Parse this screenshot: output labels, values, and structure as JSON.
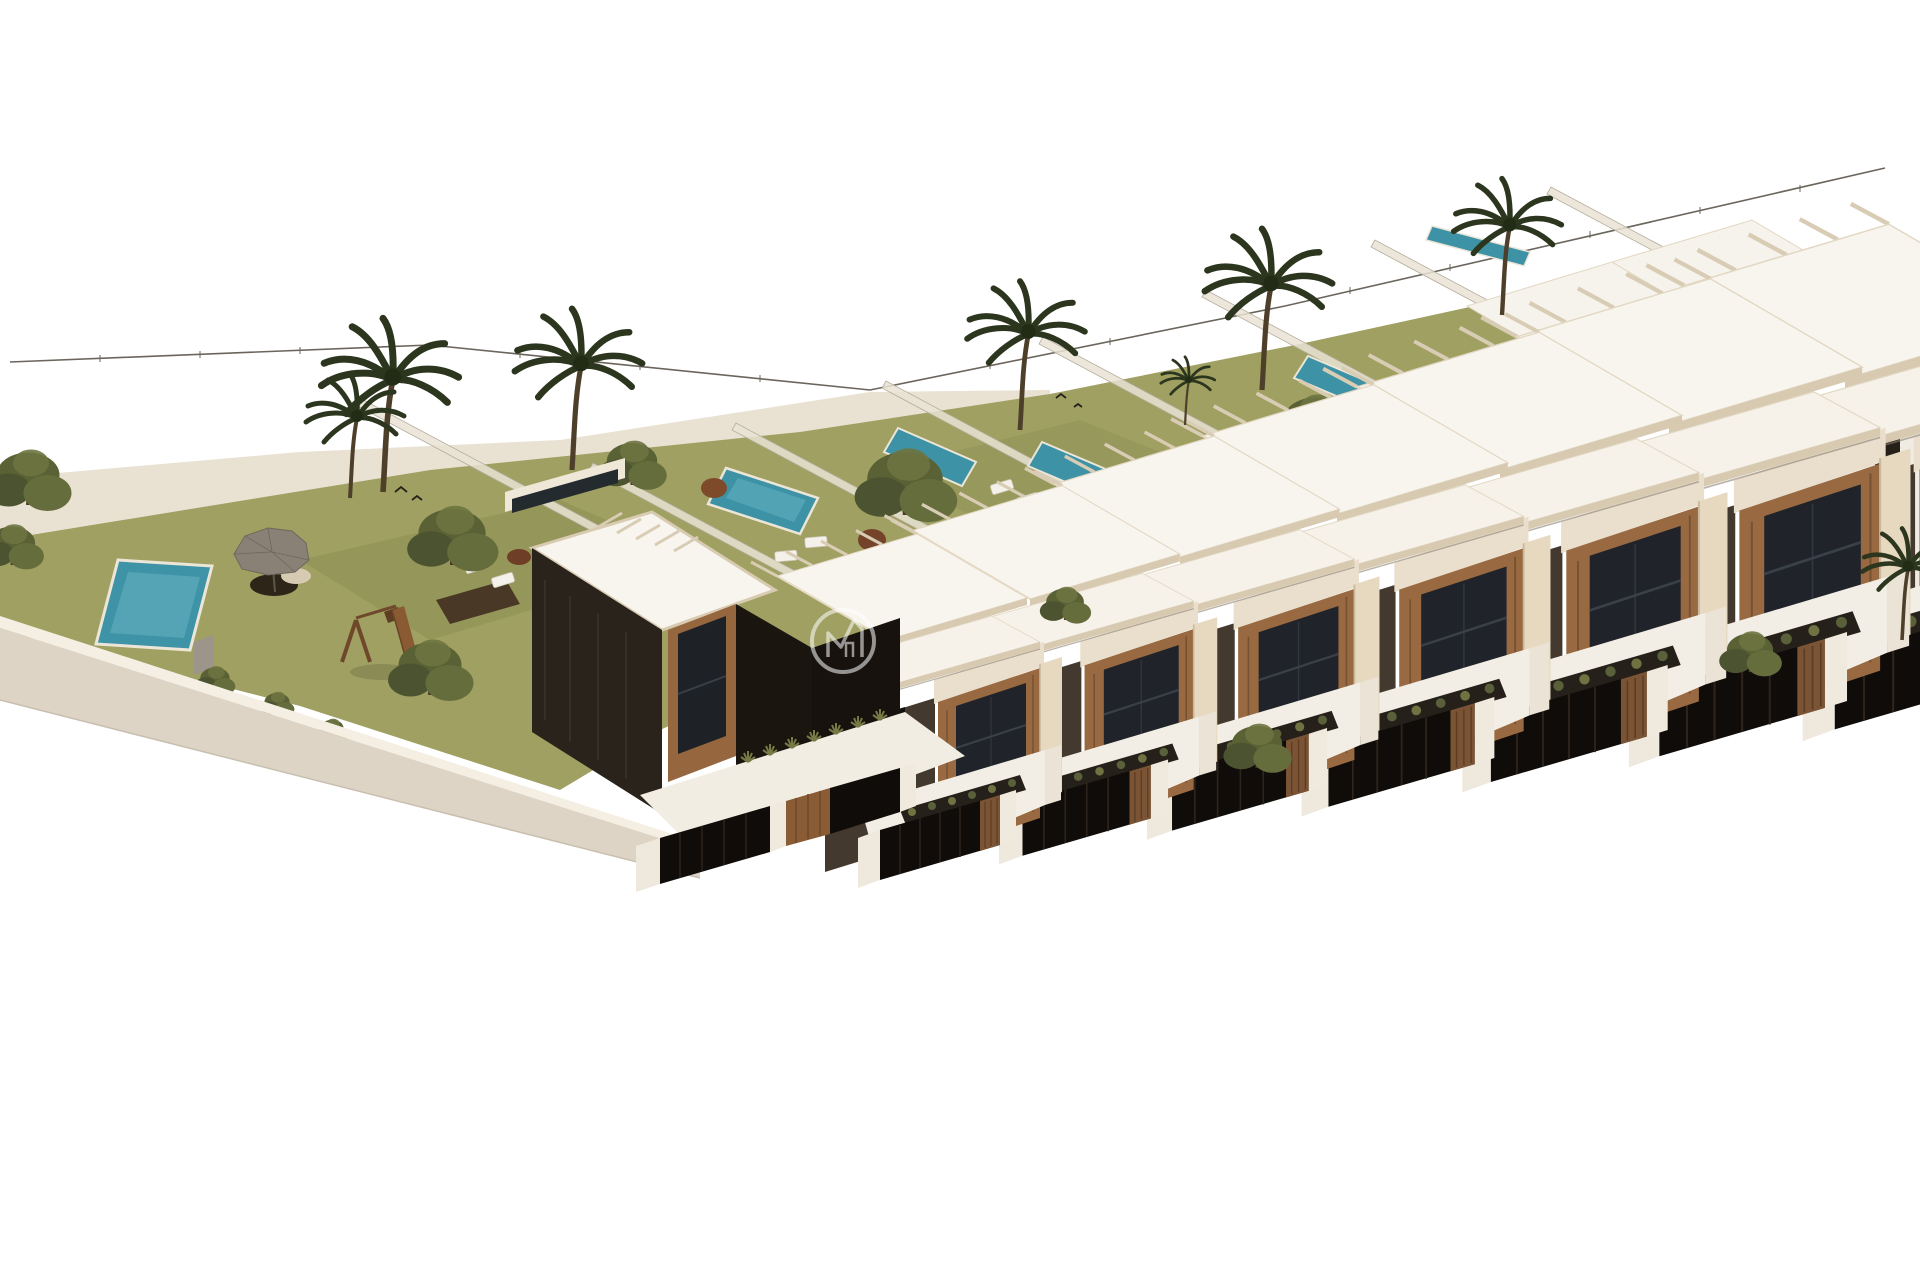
{
  "meta": {
    "title": "Aerial 3D render of new-build townhouse development",
    "description": "Isometric aerial architectural visualization of a diagonal row of modern two-storey townhouses with flat white roofs, beige parapets, wood-clad window bays and dark feature walls. Each unit has a front patio with a sunken planter and dark slatted street fence, plus a private rear garden with lawn, narrow lap pool and translucent glass dividers. A dark detached corner villa anchors the row. To the left is a communal area with lawn, swimming pool, grey parasol lounge set, timber playground, trees and palms, enclosed by a curved white perimeter wall. A thin wire boundary fence runs along the rear. A semi-transparent circular monogram watermark sits near the centre.",
    "view": "aerial-isometric",
    "background_color": "#ffffff"
  },
  "watermark": {
    "shape": "circle-outline",
    "monogram": "M-with-gable house mark",
    "color": "#ffffff",
    "opacity": 0.55
  },
  "palette": {
    "background": "#ffffff",
    "lawn": "#9fa061",
    "lawn_shade": "#8a8c52",
    "sand_path": "#e9e1d2",
    "pool_water": "#3e92a5",
    "pool_water_light": "#66b3c2",
    "roof_white": "#f8f5ef",
    "parapet_beige": "#d8cab1",
    "pillar_beige": "#e7d9c0",
    "white_wall": "#efe9dd",
    "wall_shadow": "#ded4c6",
    "dark_facade": "#43392f",
    "charcoal": "#15100c",
    "wood_cladding": "#996a41",
    "window_glass": "#20242a",
    "glass_fence": "#e9e3d4",
    "tree_foliage": "#5a6134",
    "palm_foliage": "#2c351d",
    "trunk": "#4e3f2a",
    "planter_dark": "#26201a",
    "street_fence": "#0f0c09",
    "parasol_grey": "#8a8176",
    "playground_wood": "#7a4e2a",
    "boundary_wire": "#6b655c"
  },
  "site": {
    "communal_area": {
      "features": [
        "lawn",
        "swimming-pool",
        "parasol-lounge-set",
        "timber-playground",
        "sun-loungers",
        "timber-deck",
        "entrance-gate",
        "perimeter-wall",
        "ornamental-trees",
        "palm-trees",
        "sand-path"
      ]
    },
    "townhouse_row": {
      "visible_units": 7,
      "detached_end_villa": 1,
      "unit_features": [
        "flat-white-roof",
        "beige-parapet",
        "rear-pergola",
        "wood-clad-window-bay",
        "two-storey-glazing",
        "dark-feature-wall",
        "front-patio",
        "sunken-planter",
        "dark-slat-fence",
        "white-pier",
        "private-garden",
        "lap-pool",
        "glass-garden-divider"
      ]
    },
    "rear_row_units_visible": 2,
    "private_lap_pools": 6,
    "communal_pools": 1,
    "palm_trees": 8,
    "boundary": "thin wire fence with posts"
  }
}
